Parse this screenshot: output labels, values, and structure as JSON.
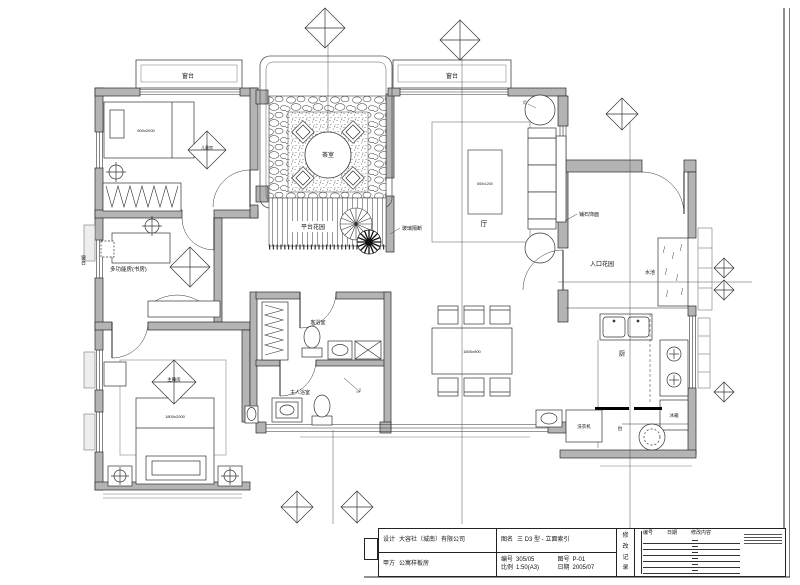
{
  "labels": {
    "bay_window_left": "窗台",
    "bay_window_right": "窗台",
    "side_window": "窗台",
    "tea_area": "茶室",
    "deck": "平台花园",
    "glass_note": "玻璃隔断",
    "living_hall": "厅",
    "coffee_table_size": "600x1200",
    "lamp": "灯",
    "entry_garden": "入口花园",
    "paving_note": "铺石饰面",
    "water_pool": "水池",
    "kitchen": "厨",
    "fridge": "冰箱",
    "washing_machine": "洗衣机",
    "counter": "台",
    "dining_table_size": "1800x900",
    "study": "多功能房(书房)",
    "child_room": "儿童房",
    "single_bed_size": "900x2000",
    "master_room": "主睡房",
    "double_bed_size": "1800x2000",
    "guest_bath": "客浴室",
    "master_bath": "主人浴室"
  },
  "title_block": {
    "designer_label": "设计",
    "designer": "大容社（城南）有限公司",
    "client_label": "甲方",
    "client": "公寓样板房",
    "drawing_name_label": "图名",
    "drawing_name": "三 D3 型 - 立面索引",
    "job_no_label": "编号",
    "job_no": "305/05",
    "scale_label": "比例",
    "scale": "1:50(A3)",
    "sheet_no_label": "图号",
    "sheet_no": "P-01",
    "date_label": "日期",
    "date": "2005/07",
    "side_column": [
      "修",
      "改",
      "记",
      "录"
    ],
    "revision_headers": [
      "编号",
      "日期",
      "修改内容"
    ]
  }
}
